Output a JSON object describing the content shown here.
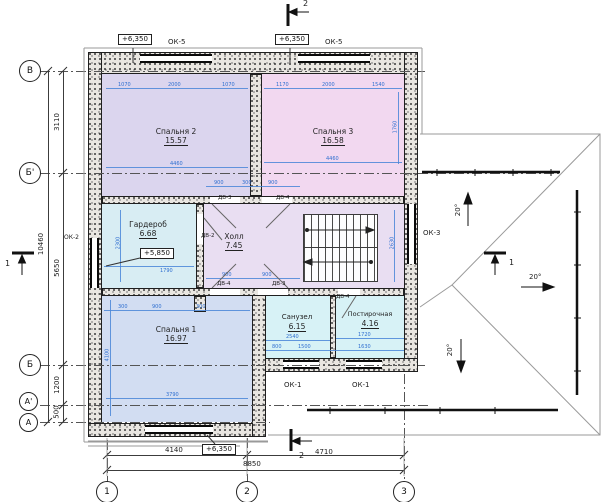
{
  "plan": {
    "rooms": [
      {
        "name": "Спальня 2",
        "area": "15.57"
      },
      {
        "name": "Спальня 3",
        "area": "16.58"
      },
      {
        "name": "Гардероб",
        "area": "6.68"
      },
      {
        "name": "Холл",
        "area": "7.45"
      },
      {
        "name": "Спальня 1",
        "area": "16.97"
      },
      {
        "name": "Санузел",
        "area": "6.15"
      },
      {
        "name": "Постирочная",
        "area": "4.16"
      }
    ],
    "grid": {
      "rows": [
        "В",
        "Б'",
        "Б",
        "А'",
        "А"
      ],
      "cols": [
        "1",
        "2",
        "3"
      ]
    },
    "elev": {
      "a": "+6,350",
      "b": "+6,350",
      "c": "+6,350",
      "w": "+5,850"
    },
    "win": {
      "ok5a": "ОК-5",
      "ok5b": "ОК-5",
      "ok2": "ОК-2",
      "ok3": "ОК-3",
      "ok1a": "ОК-1",
      "ok1b": "ОК-1"
    },
    "doors": {
      "d1": "ДВ-3",
      "d2": "ДВ-4",
      "d3": "ДВ-2",
      "d4": "ДВ-4",
      "d5": "ДВ-3",
      "d6": "ДВ-4"
    },
    "dimsL": {
      "total": "10460",
      "vb1": "3110",
      "b1b": "5650",
      "ba1": "1200",
      "a1a": "500"
    },
    "dimsB": {
      "d12": "4140",
      "d23": "4710",
      "total": "8850"
    },
    "slopes": {
      "up": "20°",
      "right": "20°",
      "down": "20°"
    },
    "sections": {
      "one": "1",
      "two": "2"
    },
    "bdims": {
      "b2top": [
        "1070",
        "2000",
        "1070"
      ],
      "b3top": [
        "1170",
        "2000",
        "1540"
      ],
      "b2mid": "4460",
      "b3mid": "4460",
      "b3v": "1760",
      "hallTop": [
        "900",
        "300",
        "900"
      ],
      "hallBot": [
        "900",
        "900"
      ],
      "wardV": "2300",
      "wardMid": "1790",
      "s1top": [
        "300",
        "900",
        "300"
      ],
      "s1v": "4100",
      "s1bot": "3790",
      "san": "2540",
      "laun": "1720",
      "wing": [
        "800",
        "1500",
        "1630"
      ],
      "stairV": "2630"
    },
    "colors": {
      "dim_blue": "#4a86d8",
      "bed2": "#dbd5ee",
      "bed3": "#f2d8f0",
      "ward": "#d8edf3",
      "hall": "#e9def2",
      "bed1": "#d2ddf2",
      "wet": "#d7f2f6"
    }
  }
}
